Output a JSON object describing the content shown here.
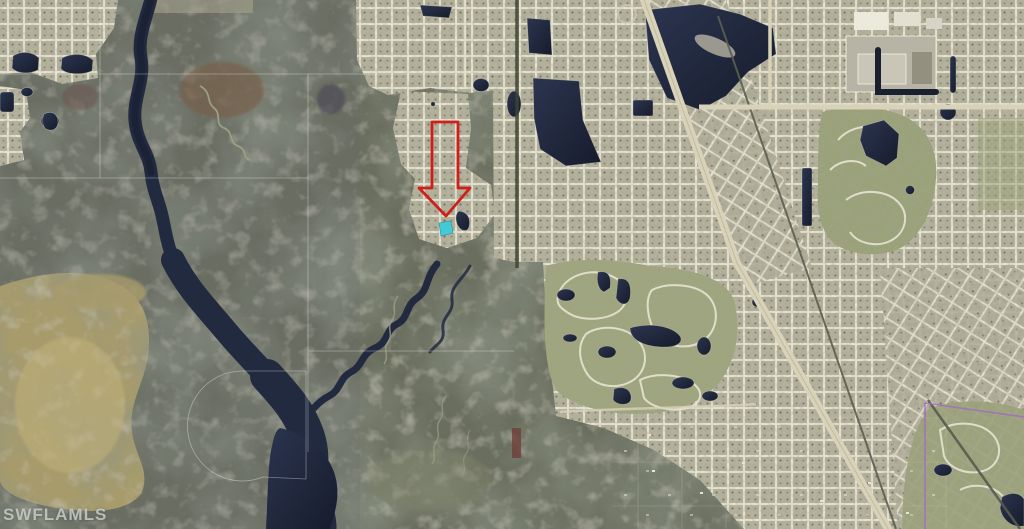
{
  "image": {
    "kind": "aerial-satellite-photo",
    "description": "aerial photo of wetlands with winding dark river on left and dense residential street grids on right"
  },
  "watermark": {
    "text": "SWFLAMLS",
    "color": "#d2d7d2"
  },
  "annotations": {
    "arrow": {
      "shape": "hollow-down-arrow",
      "color": "#d01f1a"
    },
    "highlighted_lot": {
      "color": "#45c9d6"
    }
  },
  "map": {
    "palette": {
      "marsh": "#676b5c",
      "tan_marsh": "#a79b6c",
      "suburb_blocks": "#b5b29c",
      "streets": "#e8e5d3",
      "water": "#1d2434",
      "highway": "#d8d2b9",
      "golf_green": "#9aa277",
      "boundary_line": "#a26cc2"
    },
    "features": [
      "winding-dark-river",
      "wetland-preserve",
      "tan-marsh-flat",
      "residential-street-grid",
      "large-lakes",
      "diagonal-highway",
      "railroad-corridor",
      "golf-course-communities",
      "commercial-big-box-area",
      "purple-boundary-line",
      "section-survey-lines"
    ]
  }
}
